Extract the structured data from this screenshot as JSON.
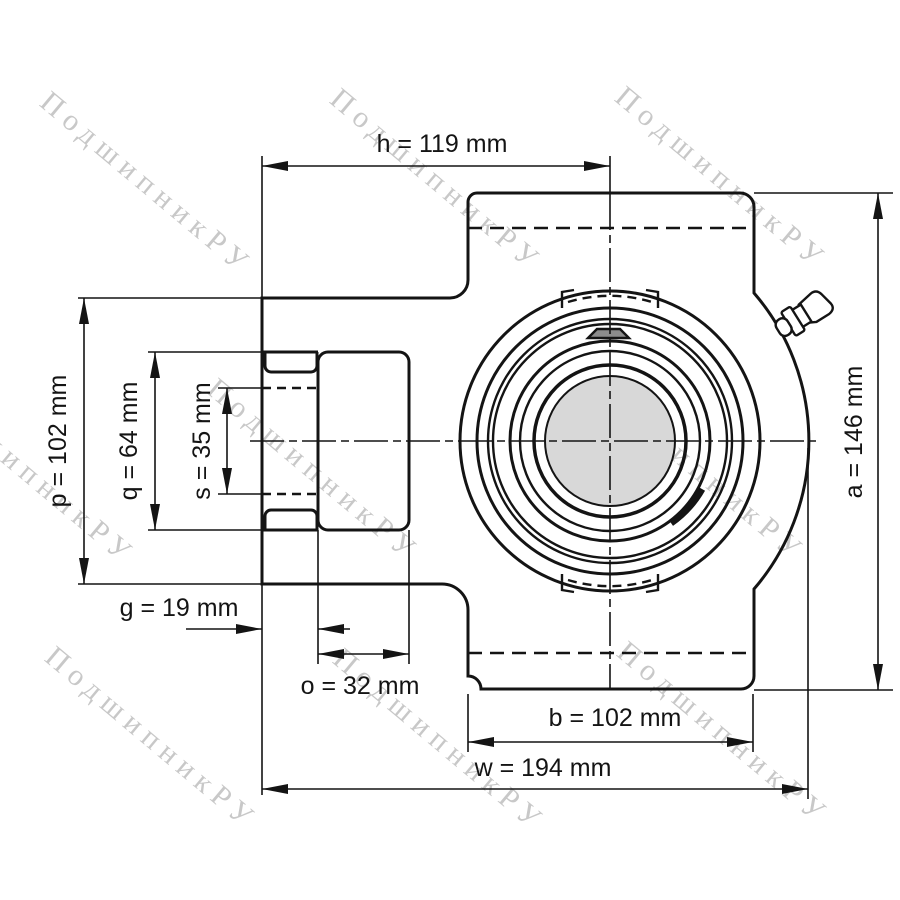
{
  "watermark": {
    "text": "ПодшипникРУ"
  },
  "drawing": {
    "type": "technical-dimension-drawing",
    "subject": "take-up bearing unit, front view",
    "units": "mm",
    "dimensions": {
      "h": {
        "name": "h",
        "value": 119,
        "unit": "mm",
        "label": "h = 119 mm"
      },
      "p": {
        "name": "p",
        "value": 102,
        "unit": "mm",
        "label": "p = 102 mm"
      },
      "q": {
        "name": "q",
        "value": 64,
        "unit": "mm",
        "label": "q = 64 mm"
      },
      "s": {
        "name": "s",
        "value": 35,
        "unit": "mm",
        "label": "s = 35 mm"
      },
      "a": {
        "name": "a",
        "value": 146,
        "unit": "mm",
        "label": "a = 146 mm"
      },
      "g": {
        "name": "g",
        "value": 19,
        "unit": "mm",
        "label": "g = 19 mm"
      },
      "o": {
        "name": "o",
        "value": 32,
        "unit": "mm",
        "label": "o = 32 mm"
      },
      "b": {
        "name": "b",
        "value": 102,
        "unit": "mm",
        "label": "b = 102 mm"
      },
      "w": {
        "name": "w",
        "value": 194,
        "unit": "mm",
        "label": "w = 194 mm"
      }
    }
  }
}
